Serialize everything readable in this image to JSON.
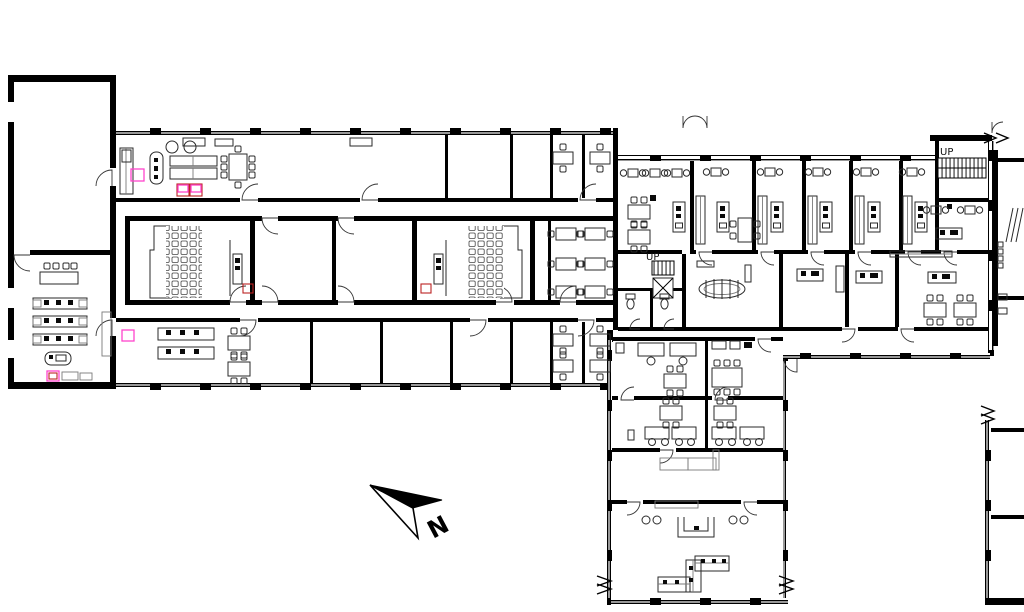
{
  "plan": {
    "labels": {
      "stair_core": "UP",
      "stair_northeast": "UP",
      "north": "N"
    },
    "colors": {
      "wall": "#000000",
      "background": "#ffffff",
      "furniture": "#2a2a2a",
      "furniture_light": "#7a7a7a",
      "highlight_magenta": "#ff44cc",
      "highlight_red": "#bb2222"
    }
  }
}
